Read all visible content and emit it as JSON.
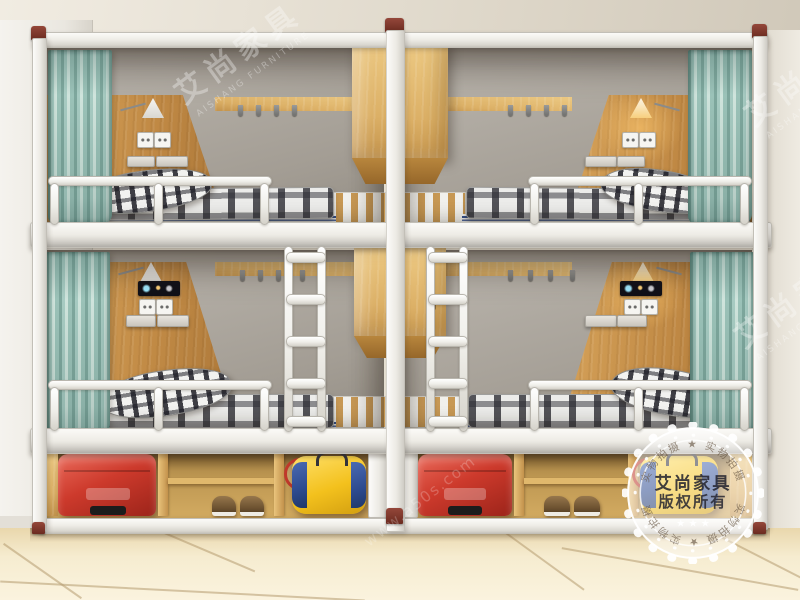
{
  "scene": {
    "description": "Product photo: two white-frame dormitory bunk beds with oak privacy panels, teal curtains, plaid mattresses, yellow pillows, wall lamps, power outlets, center ladders and hanging lockers, under-bed storage holding red suitcases, shoes, a racket and a yellow duffel bag, on a beige tiled floor",
    "bed_count": 4
  },
  "watermark": {
    "brand_cn": "艾尚家具",
    "brand_en": "AISHANG FURNITURE",
    "url_text": "www.a50s.com"
  },
  "stamp": {
    "title": "艾尚家具",
    "subtitle": "版权所有",
    "ring_top": "实物拍摄 ★ 实物拍摄",
    "ring_bottom": "实物拍摄 ★ 实物拍摄",
    "stars": "★ ★ ★",
    "star": "★"
  },
  "colors": {
    "frame_white": "#f4f2ee",
    "curtain_teal": "#a5c8bf",
    "wood_panel": "#c98f49",
    "wood_light": "#e4bb6e",
    "gray_panel": "#a8a299",
    "suitcase_red": "#c93a2d",
    "bag_yellow": "#f3c11d",
    "bag_blue": "#2d4a8e",
    "pillow_yellow": "#e2a838",
    "stripe_blue": "#33508e",
    "post_cap_red": "#7c352a",
    "floor_tile": "#f3e6c2"
  }
}
